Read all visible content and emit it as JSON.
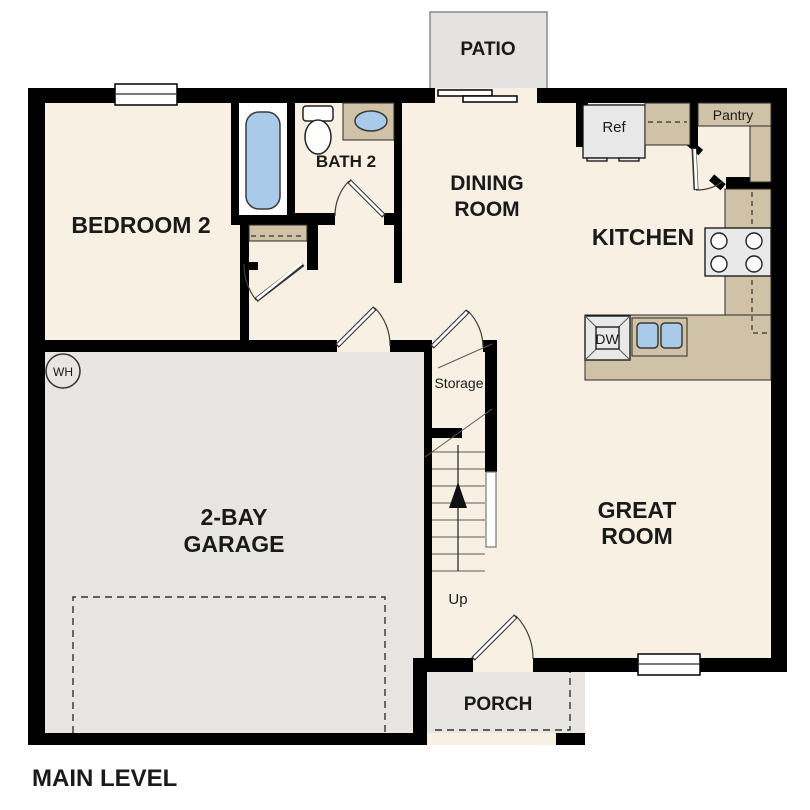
{
  "title": "MAIN LEVEL",
  "colors": {
    "wall": "#000000",
    "floor": "#F8F1E3",
    "garage_floor": "#E7E6E3",
    "patio_floor": "#E4E3E1",
    "counter_tan": "#CFC2A6",
    "fixture_blue": "#A9CBE9",
    "appliance_gray": "#E9E9E9"
  },
  "rooms": {
    "bedroom2": {
      "label": "BEDROOM 2"
    },
    "bath2": {
      "label": "BATH 2"
    },
    "dining": {
      "line1": "DINING",
      "line2": "ROOM"
    },
    "kitchen": {
      "label": "KITCHEN"
    },
    "great_room": {
      "line1": "GREAT",
      "line2": "ROOM"
    },
    "garage": {
      "line1": "2-BAY",
      "line2": "GARAGE"
    },
    "patio": {
      "label": "PATIO"
    },
    "porch": {
      "label": "PORCH"
    },
    "storage": {
      "label": "Storage"
    }
  },
  "fixtures": {
    "refrigerator": "Ref",
    "pantry": "Pantry",
    "dishwasher": "DW",
    "water_heater": "WH",
    "stairs_direction": "Up"
  }
}
